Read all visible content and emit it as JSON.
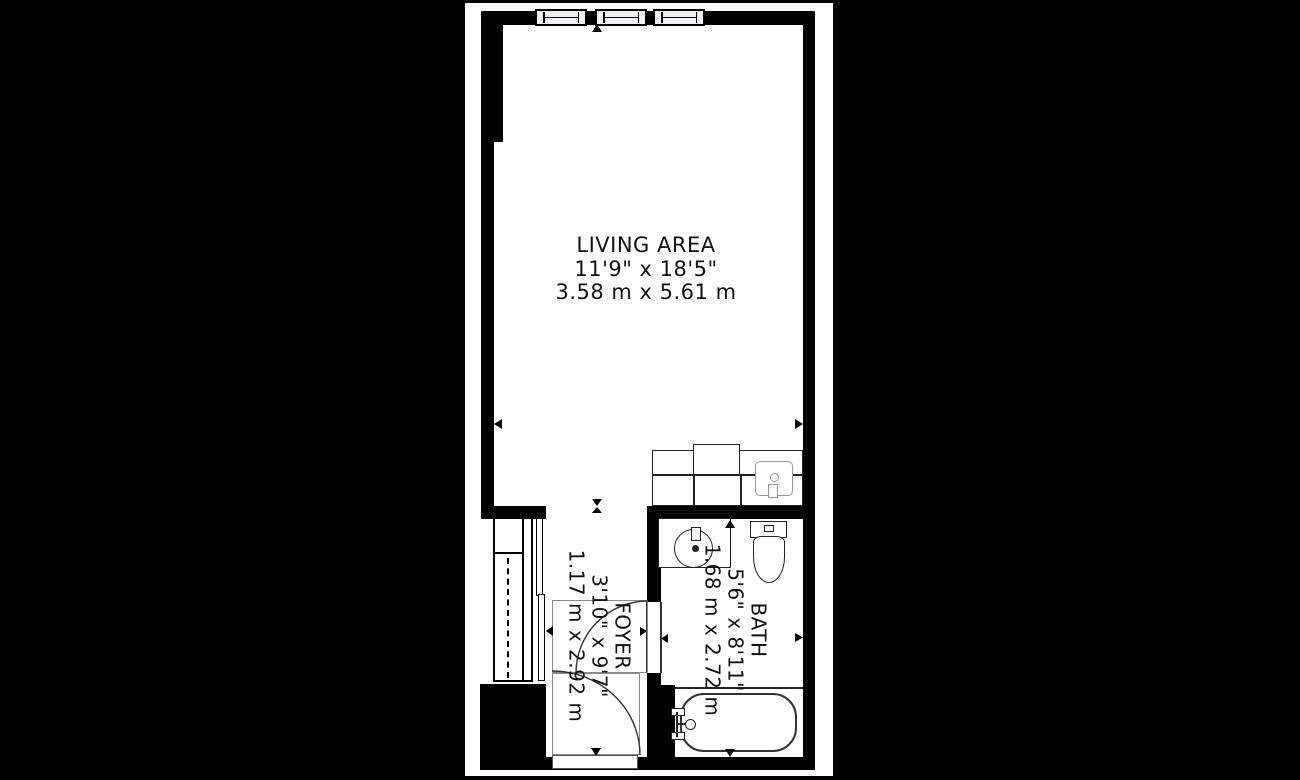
{
  "plan": {
    "colors": {
      "background": "#000000",
      "canvas": "#ffffff",
      "wall": "#000000",
      "window_fill": "#eef0f4",
      "fixture_line": "#222222",
      "fixture_gray": "#999999",
      "text": "#111111"
    },
    "rooms": {
      "living": {
        "name": "LIVING AREA",
        "imperial": "11'9\" x 18'5\"",
        "metric": "3.58 m x 5.61 m"
      },
      "foyer": {
        "name": "FOYER",
        "imperial": "3'10\" x 9'7\"",
        "metric": "1.17 m x 2.92 m"
      },
      "bath": {
        "name": "BATH",
        "imperial": "5'6\" x 8'11\"",
        "metric": "1.68 m x 2.72 m"
      }
    }
  }
}
